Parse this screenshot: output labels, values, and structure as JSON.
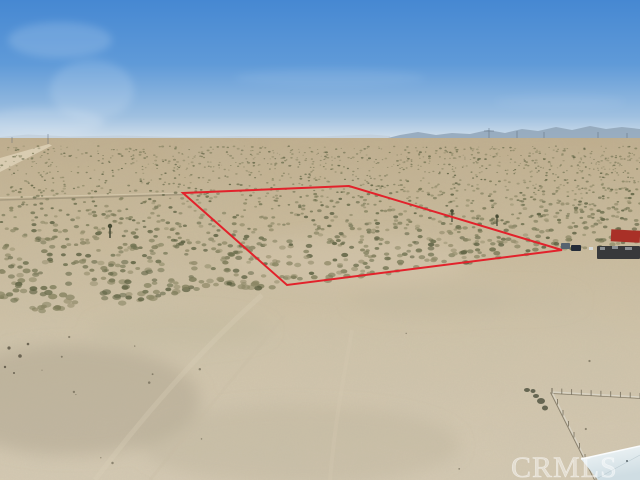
{
  "scene": {
    "description": "Aerial drone photo of a vacant high-desert land parcel outlined in red, scrub brush, distant mountains and industrial skyline, CRMLS listing watermark"
  },
  "watermark": {
    "text": "CRMLS",
    "x": "511",
    "y": "477"
  },
  "boundary": {
    "points": "183,193 349,186 562,250 287,285",
    "color": "#e2222b"
  },
  "palette": {
    "sky_top": "#4688d2",
    "sky_upper": "#5f9ad8",
    "sky_lower": "#9fc0e0",
    "sky_horizon": "#d8e3ec",
    "mountain": "#92a6b9",
    "far_hills": "#b7c3cf",
    "skyline_band": "#e2e6e7",
    "warehouse_tan": "#8b7864",
    "warehouse_shadow": "#6e5c4b",
    "ground_far": "#c0ae8d",
    "ground_mid": "#c9b999",
    "ground_near": "#d0c4aa",
    "ground_front": "#d5cab3",
    "road": "#dccfb5",
    "track": "#8a8069",
    "truck_red": "#a93027",
    "vehicle_dark": "#38393b",
    "roof_top": "#f2f7f8",
    "roof_bottom": "#cfdde3",
    "fence_rail": "#d9d4c6",
    "fence_shadow": "#6b6453"
  },
  "scrub": {
    "seed": 13,
    "colors": [
      "#6f7150",
      "#7e7c5a",
      "#8b8765",
      "#5f6344",
      "#968f6e"
    ],
    "far": {
      "count": 520,
      "y_min": 146,
      "y_max": 166
    },
    "near": {
      "count": 1500,
      "y_top": 166
    },
    "bottom_limit": [
      [
        0,
        316
      ],
      [
        287,
        287
      ],
      [
        560,
        252
      ],
      [
        640,
        242
      ]
    ],
    "foreground_specks": {
      "count": 16,
      "y_min": 305,
      "y_max": 470,
      "color": "#55503e"
    },
    "skyline_specks": {
      "count": 30,
      "colors": [
        "#f1f3f3",
        "#e4e7e8",
        "#c9cdd0"
      ]
    }
  },
  "fence": {
    "corner": [
      552,
      392
    ],
    "rail_right_end": [
      640,
      397
    ],
    "rail_down_end": [
      596,
      480
    ],
    "post_spacing": 9
  }
}
